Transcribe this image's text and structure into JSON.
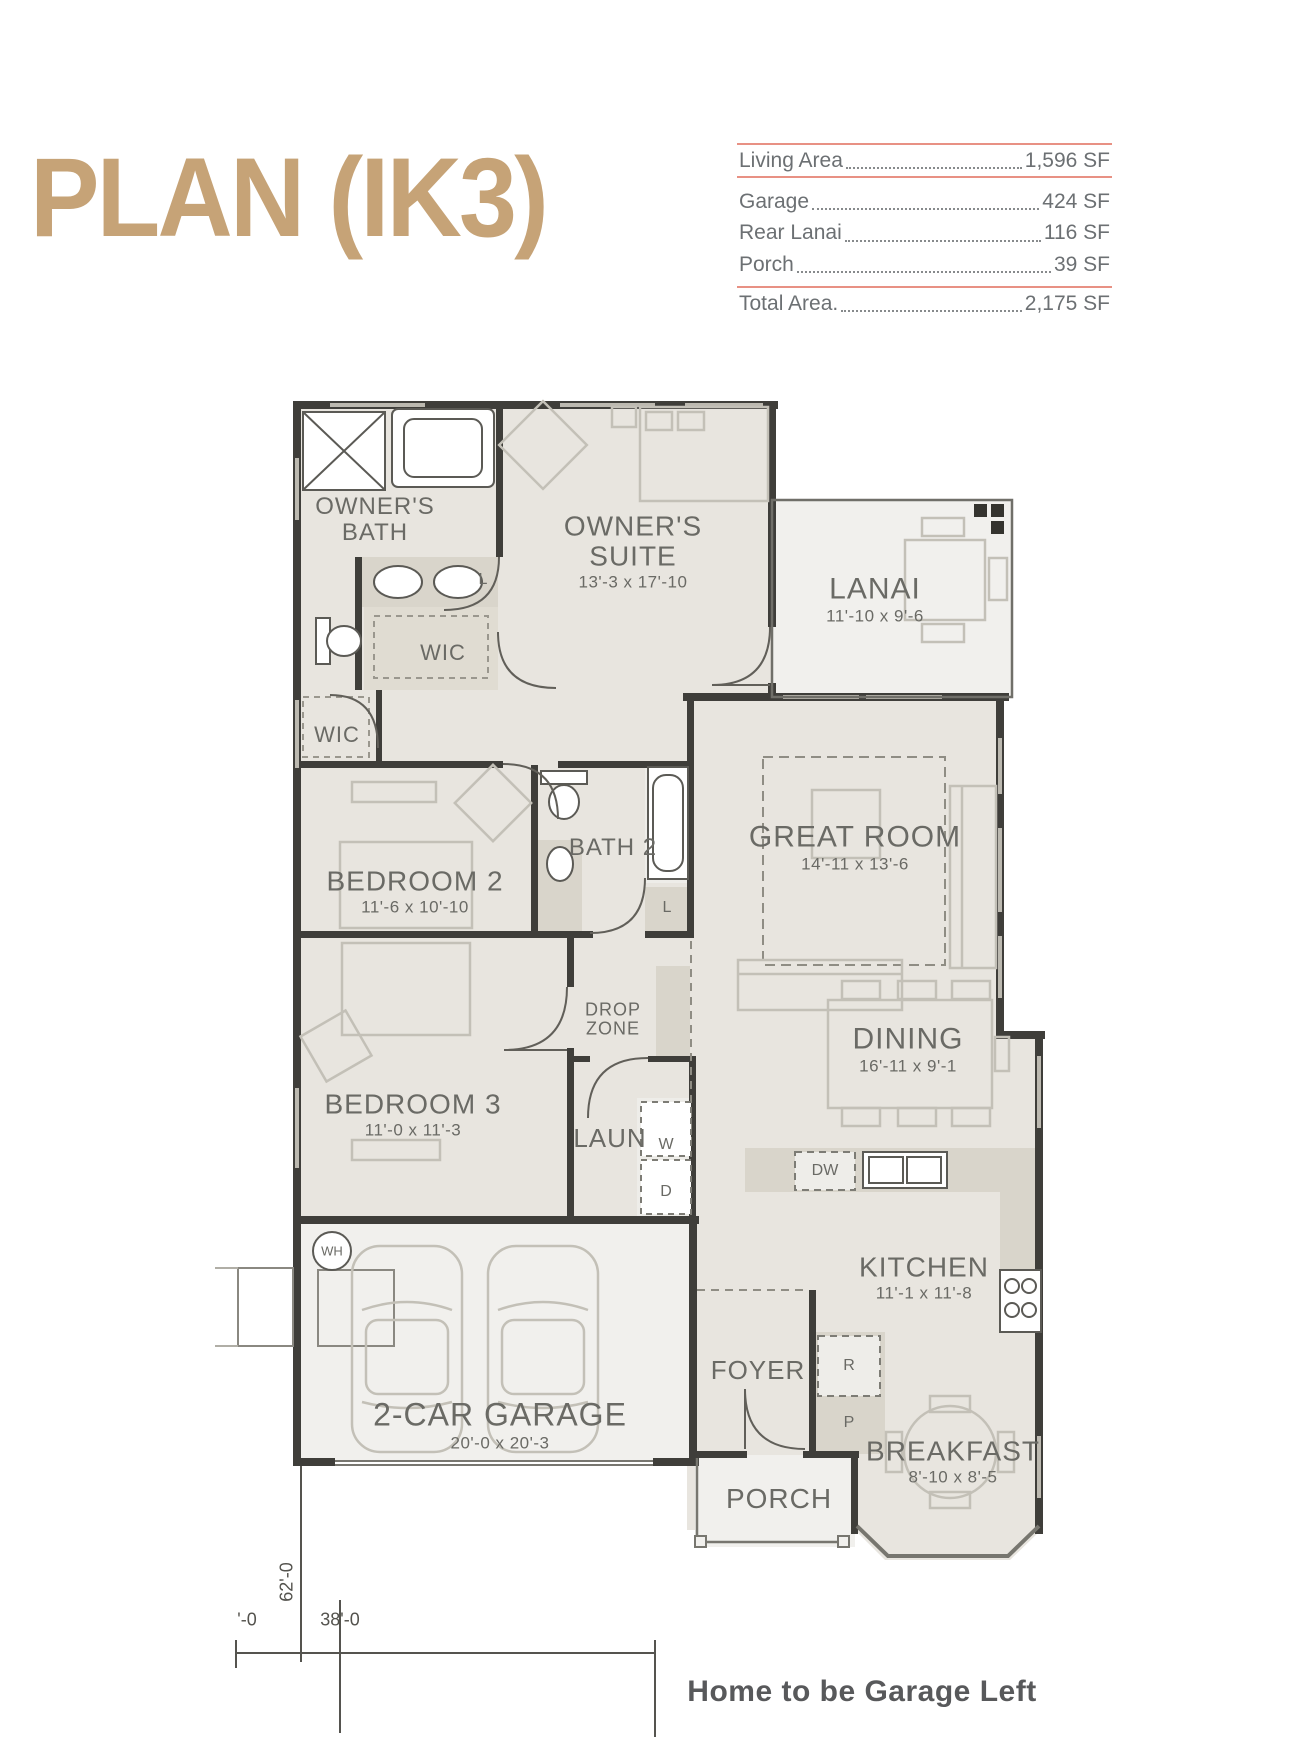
{
  "title": "PLAN (IK3)",
  "area_table": {
    "rows": [
      {
        "label": "Living Area",
        "value": "1,596 SF"
      },
      {
        "label": "Garage",
        "value": "424 SF"
      },
      {
        "label": "Rear Lanai",
        "value": "116 SF"
      },
      {
        "label": "Porch",
        "value": "39 SF"
      }
    ],
    "total": {
      "label": "Total Area.",
      "value": "2,175 SF"
    }
  },
  "rooms": {
    "owners_bath": {
      "name": "OWNER'S BATH"
    },
    "owners_suite": {
      "name": "OWNER'S SUITE",
      "dims": "13'-3 x 17'-10"
    },
    "wic_upper": {
      "name": "WIC"
    },
    "wic_lower": {
      "name": "WIC"
    },
    "lanai": {
      "name": "LANAI",
      "dims": "11'-10 x 9'-6"
    },
    "bedroom2": {
      "name": "BEDROOM 2",
      "dims": "11'-6 x 10'-10"
    },
    "bath2": {
      "name": "BATH 2"
    },
    "great_room": {
      "name": "GREAT ROOM",
      "dims": "14'-11 x 13'-6"
    },
    "dining": {
      "name": "DINING",
      "dims": "16'-11 x 9'-1"
    },
    "bedroom3": {
      "name": "BEDROOM 3",
      "dims": "11'-0 x 11'-3"
    },
    "drop_zone": {
      "name": "DROP ZONE"
    },
    "laundry": {
      "name": "LAUN"
    },
    "kitchen": {
      "name": "KITCHEN",
      "dims": "11'-1 x 11'-8"
    },
    "foyer": {
      "name": "FOYER"
    },
    "porch": {
      "name": "PORCH"
    },
    "breakfast": {
      "name": "BREAKFAST",
      "dims": "8'-10 x 8'-5"
    },
    "garage": {
      "name": "2-CAR GARAGE",
      "dims": "20'-0 x 20'-3"
    }
  },
  "fixtures": {
    "water_heater": "WH",
    "washer": "W",
    "dryer": "D",
    "dishwasher": "DW",
    "refrigerator": "R",
    "pantry": "P",
    "linen": "L"
  },
  "dimensions": {
    "depth": "62'-0",
    "width": "38'-0",
    "partial": "'-0"
  },
  "footer_note": "Home to be Garage Left",
  "colors": {
    "title_tan": "#c6a377",
    "table_rule_salmon": "#e89184",
    "wall_dark": "#3f3e3a",
    "room_fill": "#e8e5df",
    "outdoor_fill": "#f1f0ed",
    "label_gray": "#6a6a65"
  }
}
